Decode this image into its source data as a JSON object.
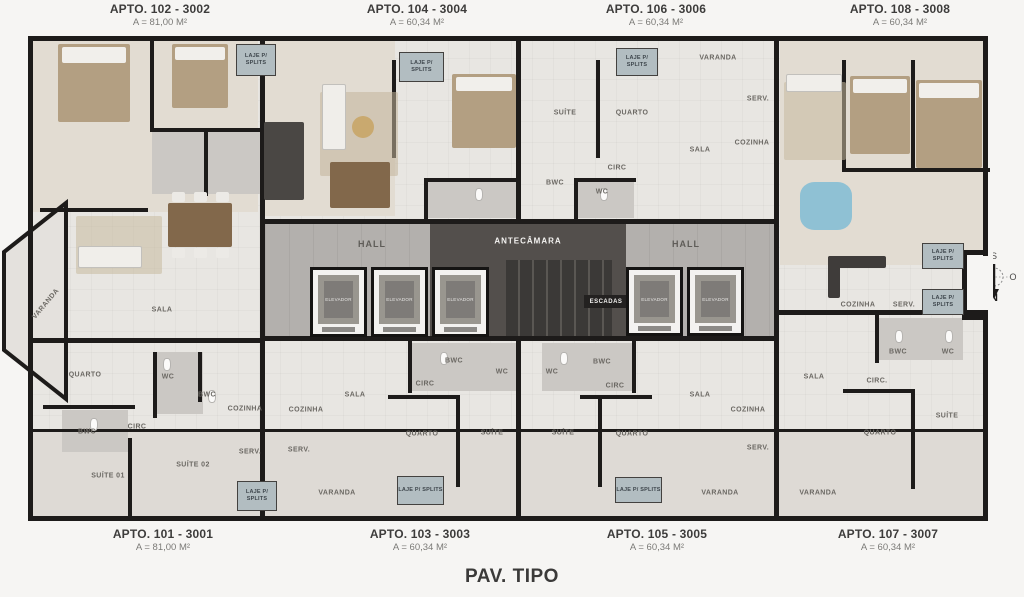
{
  "page": {
    "title": "PAV. TIPO"
  },
  "captions": {
    "top": [
      {
        "name": "APTO. 102 - 3002",
        "area": "A = 81,00 M²",
        "x": 160
      },
      {
        "name": "APTO. 104 - 3004",
        "area": "A = 60,34 M²",
        "x": 417
      },
      {
        "name": "APTO. 106 - 3006",
        "area": "A = 60,34 M²",
        "x": 656
      },
      {
        "name": "APTO. 108 - 3008",
        "area": "A = 60,34 M²",
        "x": 900
      }
    ],
    "bottom": [
      {
        "name": "APTO. 101 - 3001",
        "area": "A = 81,00 M²",
        "x": 163
      },
      {
        "name": "APTO. 103 - 3003",
        "area": "A = 60,34 M²",
        "x": 420
      },
      {
        "name": "APTO. 105 - 3005",
        "area": "A = 60,34 M²",
        "x": 657
      },
      {
        "name": "APTO. 107 - 3007",
        "area": "A = 60,34 M²",
        "x": 888
      }
    ]
  },
  "core": {
    "hall_label": "HALL",
    "antecamara_label": "ANTECÂMARA",
    "escadas_label": "ESCADAS",
    "elevator_label": "ELEVADOR",
    "halls": [
      {
        "x": 372,
        "y": 244
      },
      {
        "x": 686,
        "y": 244
      }
    ],
    "elevators": [
      {
        "x": 310,
        "y": 267,
        "w": 57,
        "h": 70
      },
      {
        "x": 371,
        "y": 267,
        "w": 57,
        "h": 70
      },
      {
        "x": 432,
        "y": 267,
        "w": 57,
        "h": 70
      },
      {
        "x": 626,
        "y": 267,
        "w": 57,
        "h": 69
      },
      {
        "x": 687,
        "y": 267,
        "w": 57,
        "h": 69
      }
    ]
  },
  "laje_label": "LAJE P/ SPLITS",
  "laje_boxes": [
    {
      "x": 236,
      "y": 44,
      "w": 40,
      "h": 32
    },
    {
      "x": 399,
      "y": 52,
      "w": 45,
      "h": 30
    },
    {
      "x": 616,
      "y": 48,
      "w": 42,
      "h": 28
    },
    {
      "x": 922,
      "y": 243,
      "w": 42,
      "h": 26
    },
    {
      "x": 922,
      "y": 289,
      "w": 42,
      "h": 26
    },
    {
      "x": 237,
      "y": 481,
      "w": 40,
      "h": 30
    },
    {
      "x": 397,
      "y": 476,
      "w": 47,
      "h": 29
    },
    {
      "x": 615,
      "y": 477,
      "w": 47,
      "h": 26
    }
  ],
  "room_labels": [
    {
      "t": "VARANDA",
      "x": 46,
      "y": 304,
      "r": -50
    },
    {
      "t": "SALA",
      "x": 162,
      "y": 310
    },
    {
      "t": "QUARTO",
      "x": 85,
      "y": 375
    },
    {
      "t": "WC",
      "x": 168,
      "y": 377
    },
    {
      "t": "BWC",
      "x": 207,
      "y": 395
    },
    {
      "t": "BWC",
      "x": 87,
      "y": 432
    },
    {
      "t": "CIRC",
      "x": 137,
      "y": 427
    },
    {
      "t": "COZINHA",
      "x": 245,
      "y": 409
    },
    {
      "t": "SERV.",
      "x": 250,
      "y": 452
    },
    {
      "t": "SUÍTE 01",
      "x": 108,
      "y": 476
    },
    {
      "t": "SUÍTE 02",
      "x": 193,
      "y": 465
    },
    {
      "t": "SALA",
      "x": 355,
      "y": 395
    },
    {
      "t": "COZINHA",
      "x": 306,
      "y": 410
    },
    {
      "t": "SERV.",
      "x": 299,
      "y": 450
    },
    {
      "t": "CIRC",
      "x": 425,
      "y": 384
    },
    {
      "t": "BWC",
      "x": 454,
      "y": 361
    },
    {
      "t": "WC",
      "x": 502,
      "y": 372
    },
    {
      "t": "QUARTO",
      "x": 422,
      "y": 434
    },
    {
      "t": "SUÍTE",
      "x": 492,
      "y": 433
    },
    {
      "t": "VARANDA",
      "x": 337,
      "y": 493
    },
    {
      "t": "WC",
      "x": 552,
      "y": 372
    },
    {
      "t": "BWC",
      "x": 602,
      "y": 362
    },
    {
      "t": "CIRC",
      "x": 615,
      "y": 386
    },
    {
      "t": "SUÍTE",
      "x": 563,
      "y": 433
    },
    {
      "t": "QUARTO",
      "x": 632,
      "y": 434
    },
    {
      "t": "SALA",
      "x": 700,
      "y": 395
    },
    {
      "t": "COZINHA",
      "x": 748,
      "y": 410
    },
    {
      "t": "SERV.",
      "x": 758,
      "y": 448
    },
    {
      "t": "VARANDA",
      "x": 720,
      "y": 493
    },
    {
      "t": "SUÍTE",
      "x": 565,
      "y": 113
    },
    {
      "t": "QUARTO",
      "x": 632,
      "y": 113
    },
    {
      "t": "SALA",
      "x": 700,
      "y": 150
    },
    {
      "t": "COZINHA",
      "x": 752,
      "y": 143
    },
    {
      "t": "SERV.",
      "x": 758,
      "y": 99
    },
    {
      "t": "CIRC",
      "x": 617,
      "y": 168
    },
    {
      "t": "BWC",
      "x": 555,
      "y": 183
    },
    {
      "t": "WC",
      "x": 602,
      "y": 192
    },
    {
      "t": "VARANDA",
      "x": 718,
      "y": 58
    },
    {
      "t": "COZINHA",
      "x": 858,
      "y": 305
    },
    {
      "t": "SERV.",
      "x": 904,
      "y": 305
    },
    {
      "t": "SALA",
      "x": 814,
      "y": 377
    },
    {
      "t": "BWC",
      "x": 898,
      "y": 352
    },
    {
      "t": "WC",
      "x": 948,
      "y": 352
    },
    {
      "t": "CIRC.",
      "x": 877,
      "y": 381
    },
    {
      "t": "QUARTO",
      "x": 880,
      "y": 433
    },
    {
      "t": "SUÍTE",
      "x": 947,
      "y": 416
    },
    {
      "t": "VARANDA",
      "x": 818,
      "y": 493
    }
  ],
  "compass": {
    "s": "S",
    "l": "L",
    "o": "O",
    "n": "N"
  },
  "colors": {
    "wall": "#1d1b1a",
    "floor": "#e8e6e2",
    "hall_floor": "#b3b0ad",
    "core_dark": "#534f4c",
    "stairs": "#3b3937",
    "laje_bg": "#b2bdc1",
    "furniture_wood": "#82684b",
    "bed_tan": "#b39f82",
    "accent_blue": "#8fc1d4"
  }
}
